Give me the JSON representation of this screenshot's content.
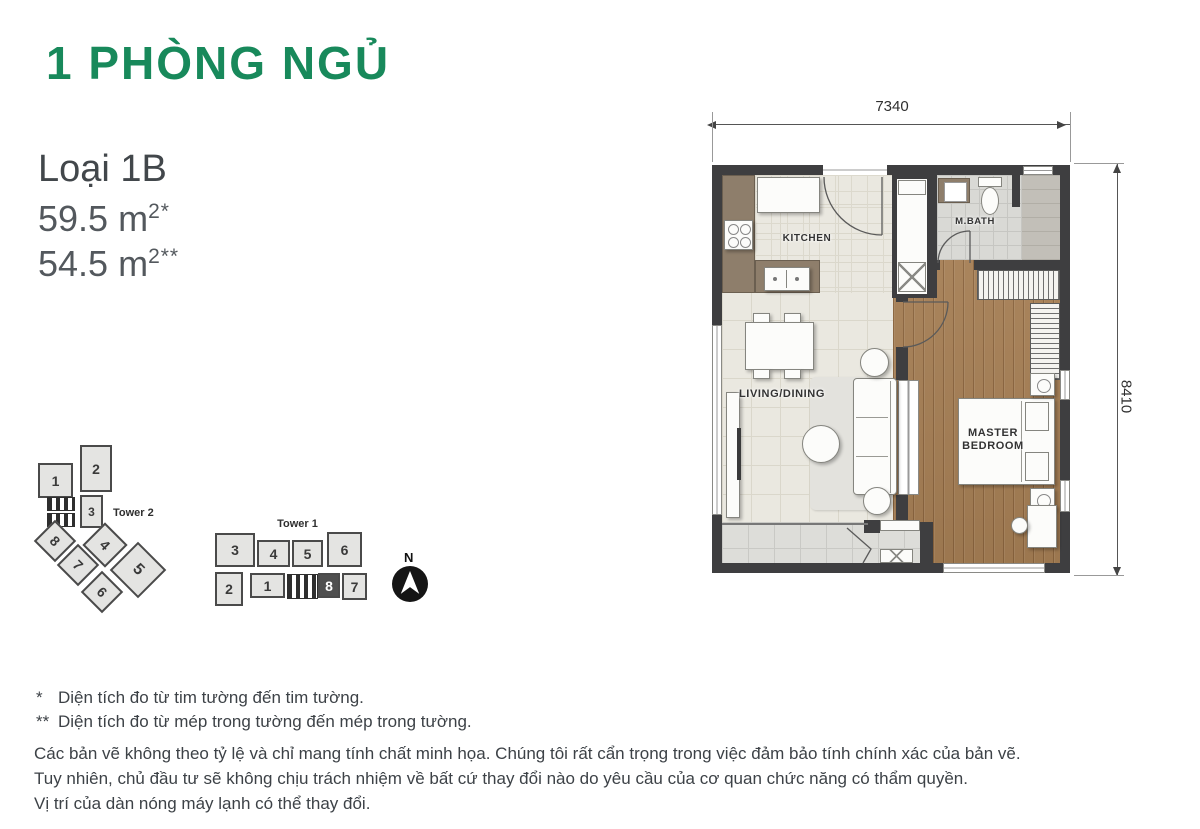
{
  "header": {
    "title": "1 PHÒNG NGỦ",
    "unit_type": "Loại 1B",
    "area1": {
      "value": "59.5 m",
      "sup": "2*"
    },
    "area2": {
      "value": "54.5 m",
      "sup": "2**"
    }
  },
  "floor_plan": {
    "dim_top": "7340",
    "dim_right": "8410",
    "rooms": {
      "kitchen": "KITCHEN",
      "mbath": "M.BATH",
      "living": "LIVING/DINING",
      "master1": "MASTER",
      "master2": "BEDROOM"
    }
  },
  "site": {
    "tower2": {
      "label": "Tower 2",
      "units": [
        "1",
        "2",
        "3",
        "8",
        "4",
        "7",
        "5",
        "6"
      ]
    },
    "tower1": {
      "label": "Tower 1",
      "top_units": [
        "3",
        "4",
        "5",
        "6"
      ],
      "bottom_units": [
        "2",
        "1",
        "8",
        "7"
      ],
      "highlighted_unit": "8"
    },
    "compass": {
      "label": "N"
    }
  },
  "footnotes": {
    "n1_marker": "*",
    "n1": "Diện tích đo từ tim tường đến tim tường.",
    "n2_marker": "**",
    "n2": "Diện tích đo từ mép trong tường đến mép trong tường.",
    "d1": "Các bản vẽ không theo tỷ lệ và chỉ mang tính chất minh họa. Chúng tôi rất cẩn trọng trong việc đảm bảo tính chính xác của bản vẽ.",
    "d2": "Tuy nhiên, chủ đầu tư sẽ không chịu trách nhiệm về bất cứ thay đổi nào do yêu cầu của cơ quan chức năng có thẩm quyền.",
    "d3": "Vị trí của dàn nóng máy lạnh có thể thay đổi."
  },
  "colors": {
    "accent_green": "#18895B",
    "wall": "#3E3E40",
    "wood_floor": "#A57E54",
    "tile_floor": "#EAE8E0",
    "bath_floor": "#D9D9D5",
    "highlight_unit": "#4F4F4F"
  }
}
